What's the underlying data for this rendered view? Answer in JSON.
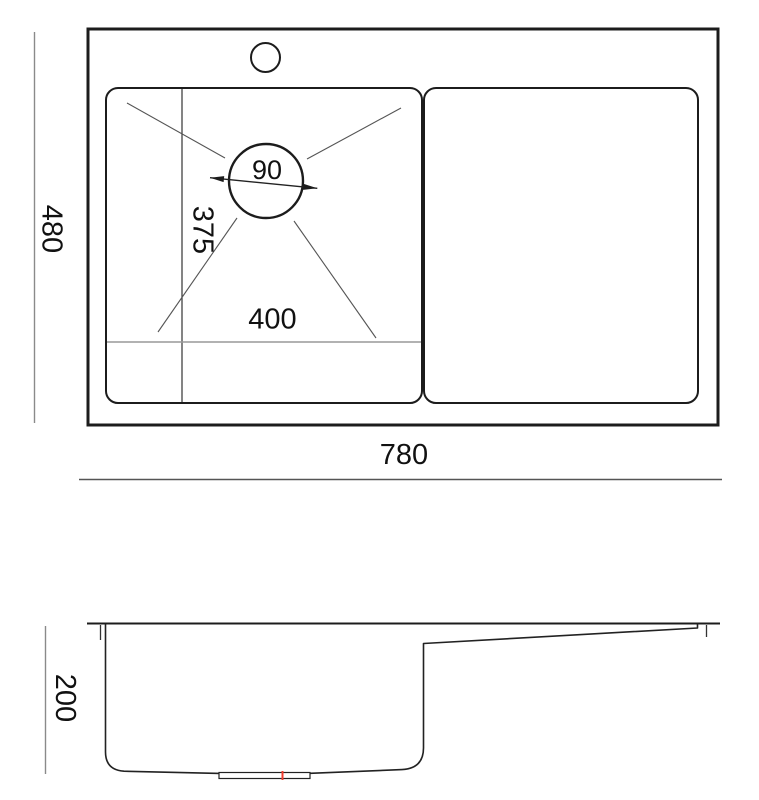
{
  "diagram": {
    "kind": "sink-dimension-drawing",
    "views": {
      "top": {
        "overall_width": "780",
        "overall_depth": "480",
        "bowl_width": "400",
        "bowl_depth": "375",
        "drain_diameter": "90"
      },
      "side": {
        "bowl_height": "200"
      }
    },
    "colors": {
      "outline": "#1c1c1c",
      "thin_line": "#555555",
      "dim_line": "#8a8a8a",
      "label": "#111111",
      "center_mark_red": "#f23b2e",
      "background": "#ffffff"
    }
  }
}
